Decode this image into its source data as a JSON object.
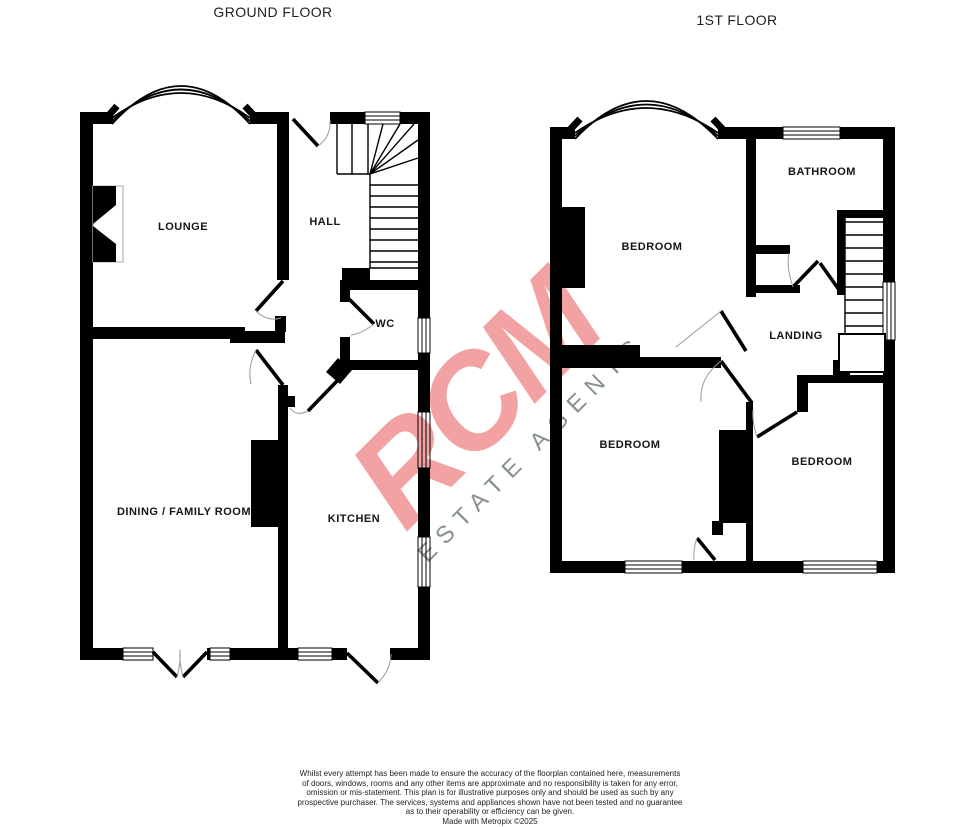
{
  "floors": {
    "ground": {
      "title": "GROUND FLOOR",
      "rooms": {
        "lounge": "LOUNGE",
        "hall": "HALL",
        "wc": "WC",
        "dining": "DINING / FAMILY ROOM",
        "kitchen": "KITCHEN"
      }
    },
    "first": {
      "title": "1ST FLOOR",
      "rooms": {
        "bedroom_front": "BEDROOM",
        "bathroom": "BATHROOM",
        "landing": "LANDING",
        "bedroom_back_left": "BEDROOM",
        "bedroom_back_right": "BEDROOM"
      }
    }
  },
  "watermark": {
    "name": "RCM",
    "tagline": "ESTATE AGENTS",
    "name_color": "#f2a2a2",
    "tagline_color": "#869090"
  },
  "disclaimer": {
    "lines": [
      "Whilst every attempt has been made to ensure the accuracy of the floorplan contained here, measurements",
      "of doors, windows, rooms and any other items are approximate and no responsibility is taken for any error,",
      "omission or mis-statement. This plan is for illustrative purposes only and should be used as such by any",
      "prospective purchaser. The services, systems and appliances shown have not been tested and no guarantee",
      "as to their operability or efficiency can be given."
    ],
    "credit": "Made with Metropix ©2025"
  },
  "colors": {
    "wall": "#000000",
    "door_swing_arc": "#9a9a9a"
  }
}
